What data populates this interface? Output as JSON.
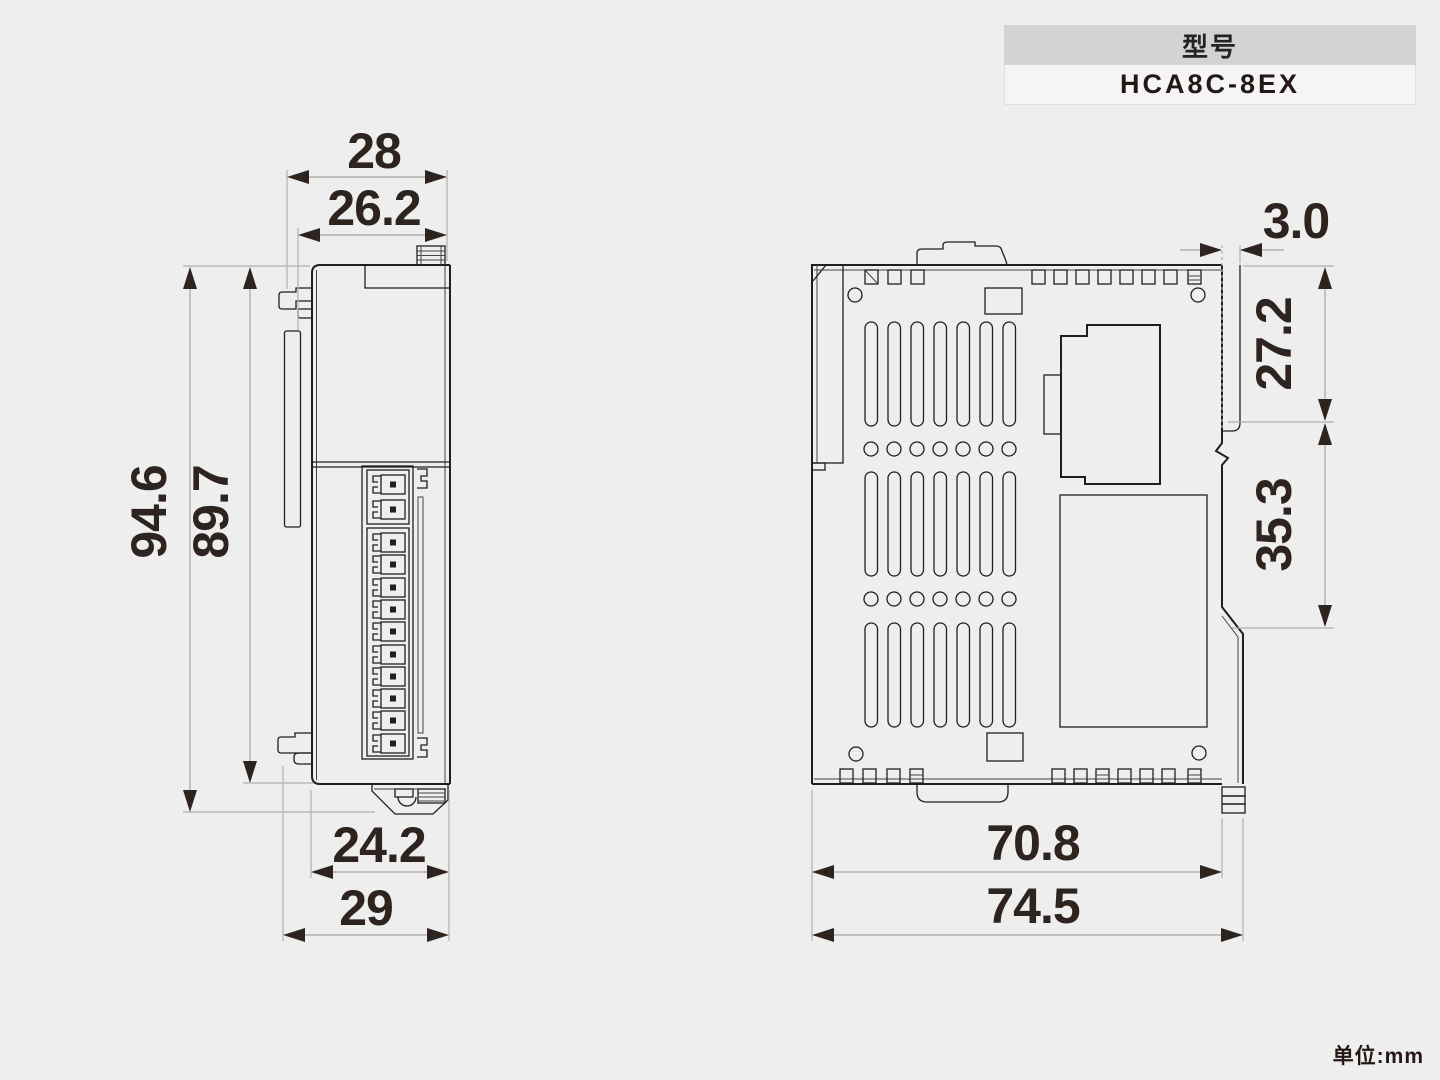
{
  "model_box": {
    "label": "型号",
    "value": "HCA8C-8EX"
  },
  "unit_note": "单位:mm",
  "front_view": {
    "dims": {
      "width_outer": "28",
      "width_inner": "26.2",
      "height_outer": "94.6",
      "height_inner": "89.7",
      "bottom_width_inner": "24.2",
      "bottom_width_outer": "29"
    }
  },
  "side_view": {
    "dims": {
      "flange_width": "3.0",
      "upper_height": "27.2",
      "rail_section_height": "35.3",
      "bottom_width_inner": "70.8",
      "bottom_width_outer": "74.5"
    }
  },
  "colors": {
    "background": "#eeeeee",
    "drawing_line": "#1f1f1f",
    "dimension_line": "#a9a5a2",
    "dimension_text": "#2d2420",
    "model_header_bg": "#d2d3d5"
  }
}
